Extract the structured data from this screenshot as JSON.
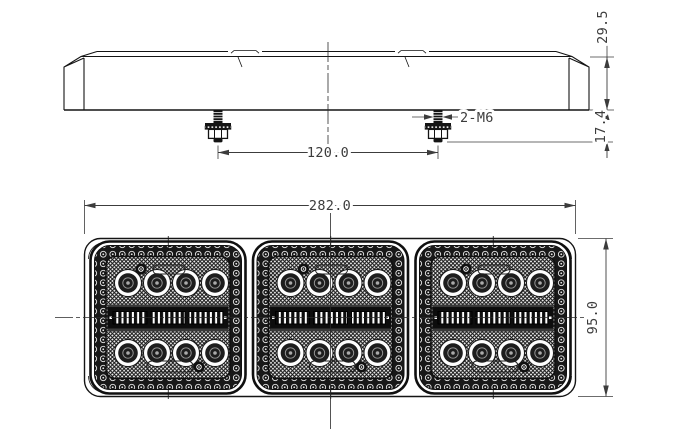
{
  "drawing": {
    "dimensions": {
      "total_height": "29.5",
      "stud_length": "17.4",
      "stud_spacing": "120.0",
      "thread_callout": "2-M6",
      "overall_width": "282.0",
      "body_height": "95.0"
    },
    "colors": {
      "line": "#141414",
      "dimension_text": "#3c3c3c",
      "background": "#ffffff"
    }
  }
}
